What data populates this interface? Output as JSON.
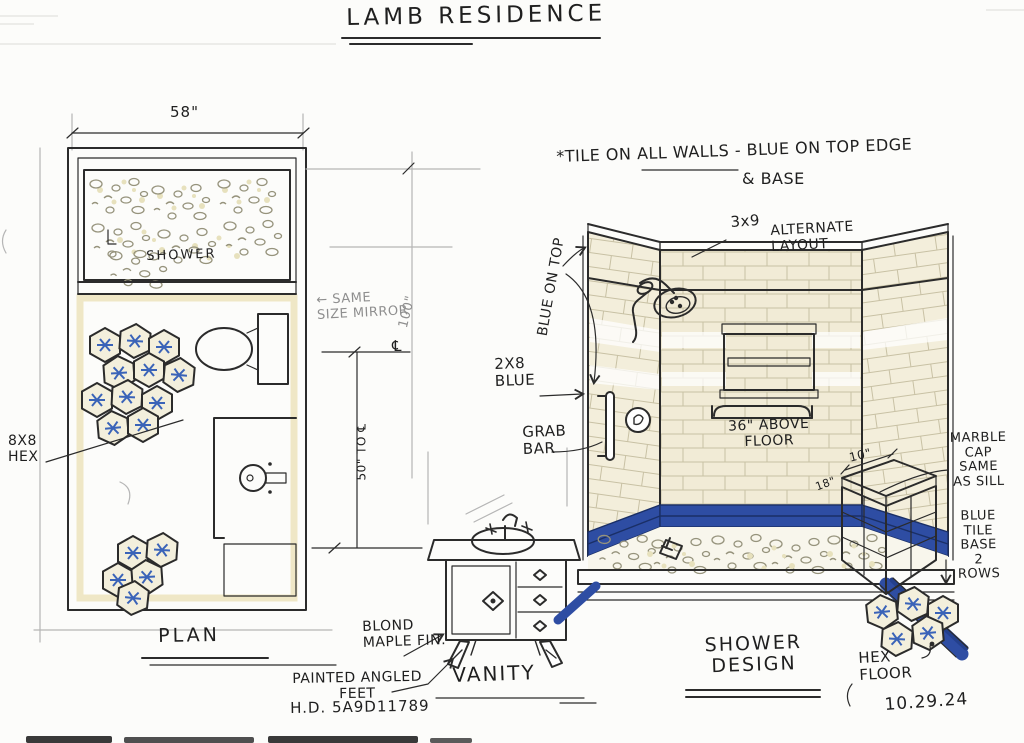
{
  "title": "LAMB RESIDENCE",
  "date": "10.29.24",
  "colors": {
    "tile_blue": "#2e4da3",
    "tile_cream": "#f1ebd6",
    "wood": "#e8dda2"
  },
  "plan": {
    "name": "PLAN",
    "width_dim": "58\"",
    "room_label": "SHOWER",
    "hex_note": "8X8\nHEX",
    "mirror_note": "← SAME\nSIZE MIRROR",
    "height_dim": "100\"",
    "vanity_dim": "50\" TO ℄",
    "centerline": "℄"
  },
  "vanity": {
    "name": "VANITY",
    "finish": "BLOND\nMAPLE FIN.",
    "feet": "PAINTED ANGLED\nFEET",
    "sku": "H.D. 5A9D11789"
  },
  "shower": {
    "name": "SHOWER\nDESIGN",
    "note1": "*TILE ON ALL WALLS - BLUE ON TOP EDGE",
    "note2": "& BASE",
    "tile_size": "3x9",
    "alt_layout": "ALTERNATE\nLAYOUT",
    "blue_top": "BLUE ON TOP",
    "blue_accent": "2X8\nBLUE",
    "grab_bar": "GRAB\nBAR",
    "grab_height": "36\" ABOVE\nFLOOR",
    "bench_depth": "10\"",
    "bench_width": "18\"",
    "marble_cap": "MARBLE\nCAP\nSAME\nAS SILL",
    "tile_base": "BLUE\nTILE\nBASE\n2\nROWS",
    "hex_floor": "HEX\nFLOOR"
  }
}
